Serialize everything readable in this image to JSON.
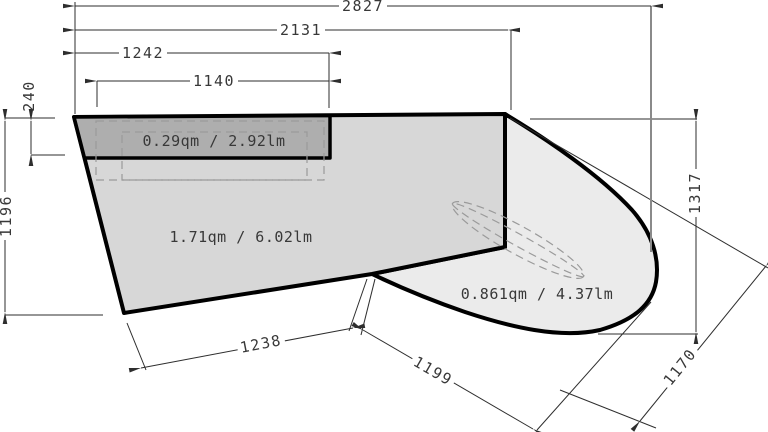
{
  "drawing": {
    "regions": {
      "shelf": {
        "area_label": "0.29qm / 2.92lm"
      },
      "main": {
        "area_label": "1.71qm / 6.02lm"
      },
      "curved": {
        "area_label": "0.861qm / 4.37lm"
      }
    },
    "dimensions": {
      "width_total": "2827",
      "width_to_corner": "2131",
      "width_shelf_outer": "1242",
      "width_shelf": "1140",
      "shelf_depth": "240",
      "height_left": "1196",
      "bottom_edge": "1238",
      "bottom_diagonal": "1199",
      "height_right": "1317",
      "diagonal_right": "1170"
    },
    "colors": {
      "shelf_fill": "#aeaeae",
      "main_fill": "#d7d7d7",
      "curved_fill": "#ebebeb",
      "outline": "#000000",
      "dim_line": "#2e2e2e",
      "hidden_line": "#9a9a9a"
    }
  }
}
